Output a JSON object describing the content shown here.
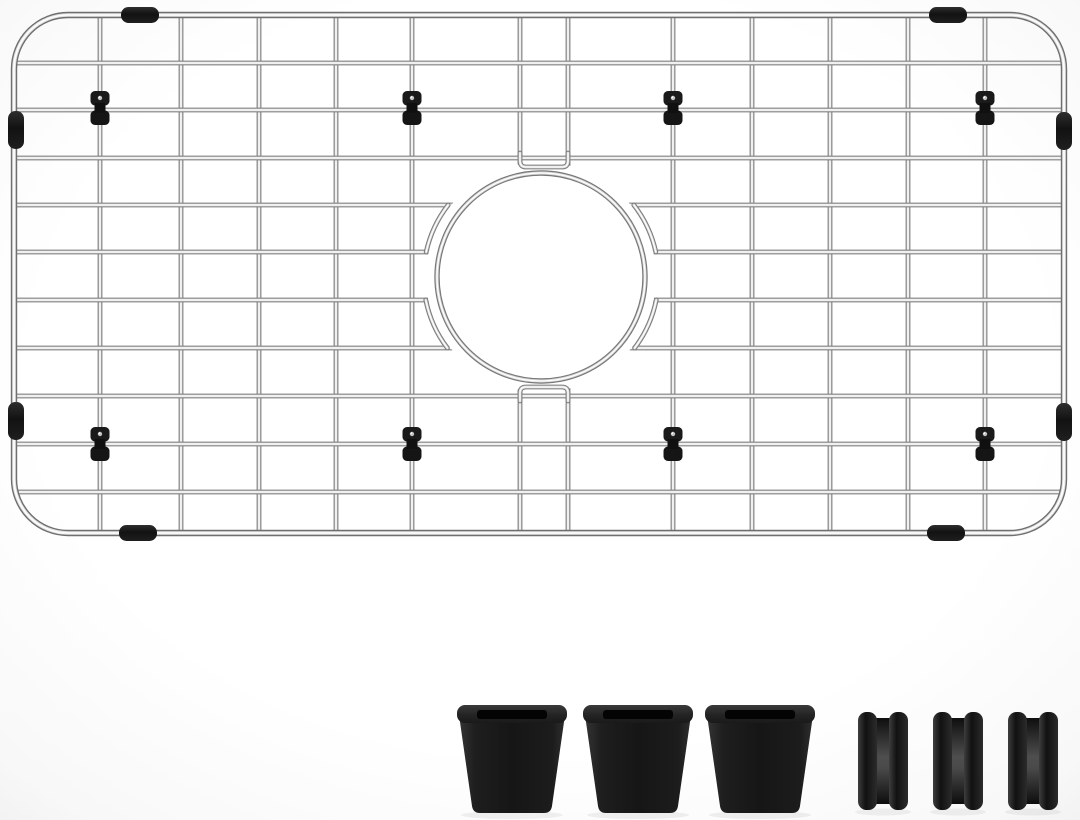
{
  "meta": {
    "description": "Stainless steel kitchen sink bottom grid with round drain opening, shown with three black rubber feet and three black side bumper clips below it",
    "background": {
      "center": "#ffffff",
      "edge": "#efefef"
    }
  },
  "grid": {
    "colors": {
      "wire_edge": "#7c7c7c",
      "wire_mid": "#d9d9d9",
      "wire_core": "#ffffff",
      "frame_edge": "#6f6f6f",
      "black_part": "#1a1a1a"
    },
    "frame": {
      "left": 14,
      "top": 15,
      "right": 1064,
      "bottom": 533,
      "corner_radius": 54
    },
    "vertical_wire_xs": [
      100,
      181,
      259,
      336,
      412,
      520,
      568,
      673,
      752,
      830,
      908,
      985
    ],
    "horizontal_wire_ys": [
      63,
      110,
      158,
      205,
      252,
      300,
      348,
      396,
      444,
      492
    ],
    "drain_opening": {
      "cx": 541,
      "cy": 277,
      "ring_radius": 104,
      "mask_radius": 115,
      "bracket_radius": 117.5,
      "bracket_wire_pairs": [
        [
          205,
          252
        ],
        [
          300,
          348
        ]
      ],
      "staple_x_left": 520,
      "staple_x_right": 568,
      "staple_top_bar_y": 167,
      "staple_bottom_bar_y": 387
    },
    "wire_clips": {
      "color": "#1a1a1a",
      "xs": [
        100,
        412,
        673,
        985
      ],
      "ys": [
        108,
        444
      ]
    },
    "edge_bumpers": {
      "color": "#161616",
      "length": 38,
      "thickness": 16,
      "horizontal_centers": [
        [
          140,
          15
        ],
        [
          948,
          15
        ],
        [
          138,
          533
        ],
        [
          946,
          533
        ]
      ],
      "vertical_centers": [
        [
          16,
          130
        ],
        [
          16,
          421
        ],
        [
          1064,
          131
        ],
        [
          1064,
          422
        ]
      ]
    }
  },
  "accessories": {
    "rubber_feet": {
      "count": 3,
      "base_color": "#1b1b1b",
      "centers_x": [
        512,
        638,
        760
      ],
      "rim_top": 705,
      "rim_height": 18,
      "rim_width": 110,
      "slot_width": 70,
      "slot_height": 9,
      "body_top": 715,
      "body_bottom": 813,
      "body_top_halfwidth": 53,
      "body_bottom_halfwidth": 39
    },
    "side_bumpers": {
      "count": 3,
      "base_color": "#1b1b1b",
      "lefts_x": [
        858,
        933,
        1008
      ],
      "width": 50,
      "top": 712,
      "bottom": 810,
      "cap_width": 19
    }
  }
}
